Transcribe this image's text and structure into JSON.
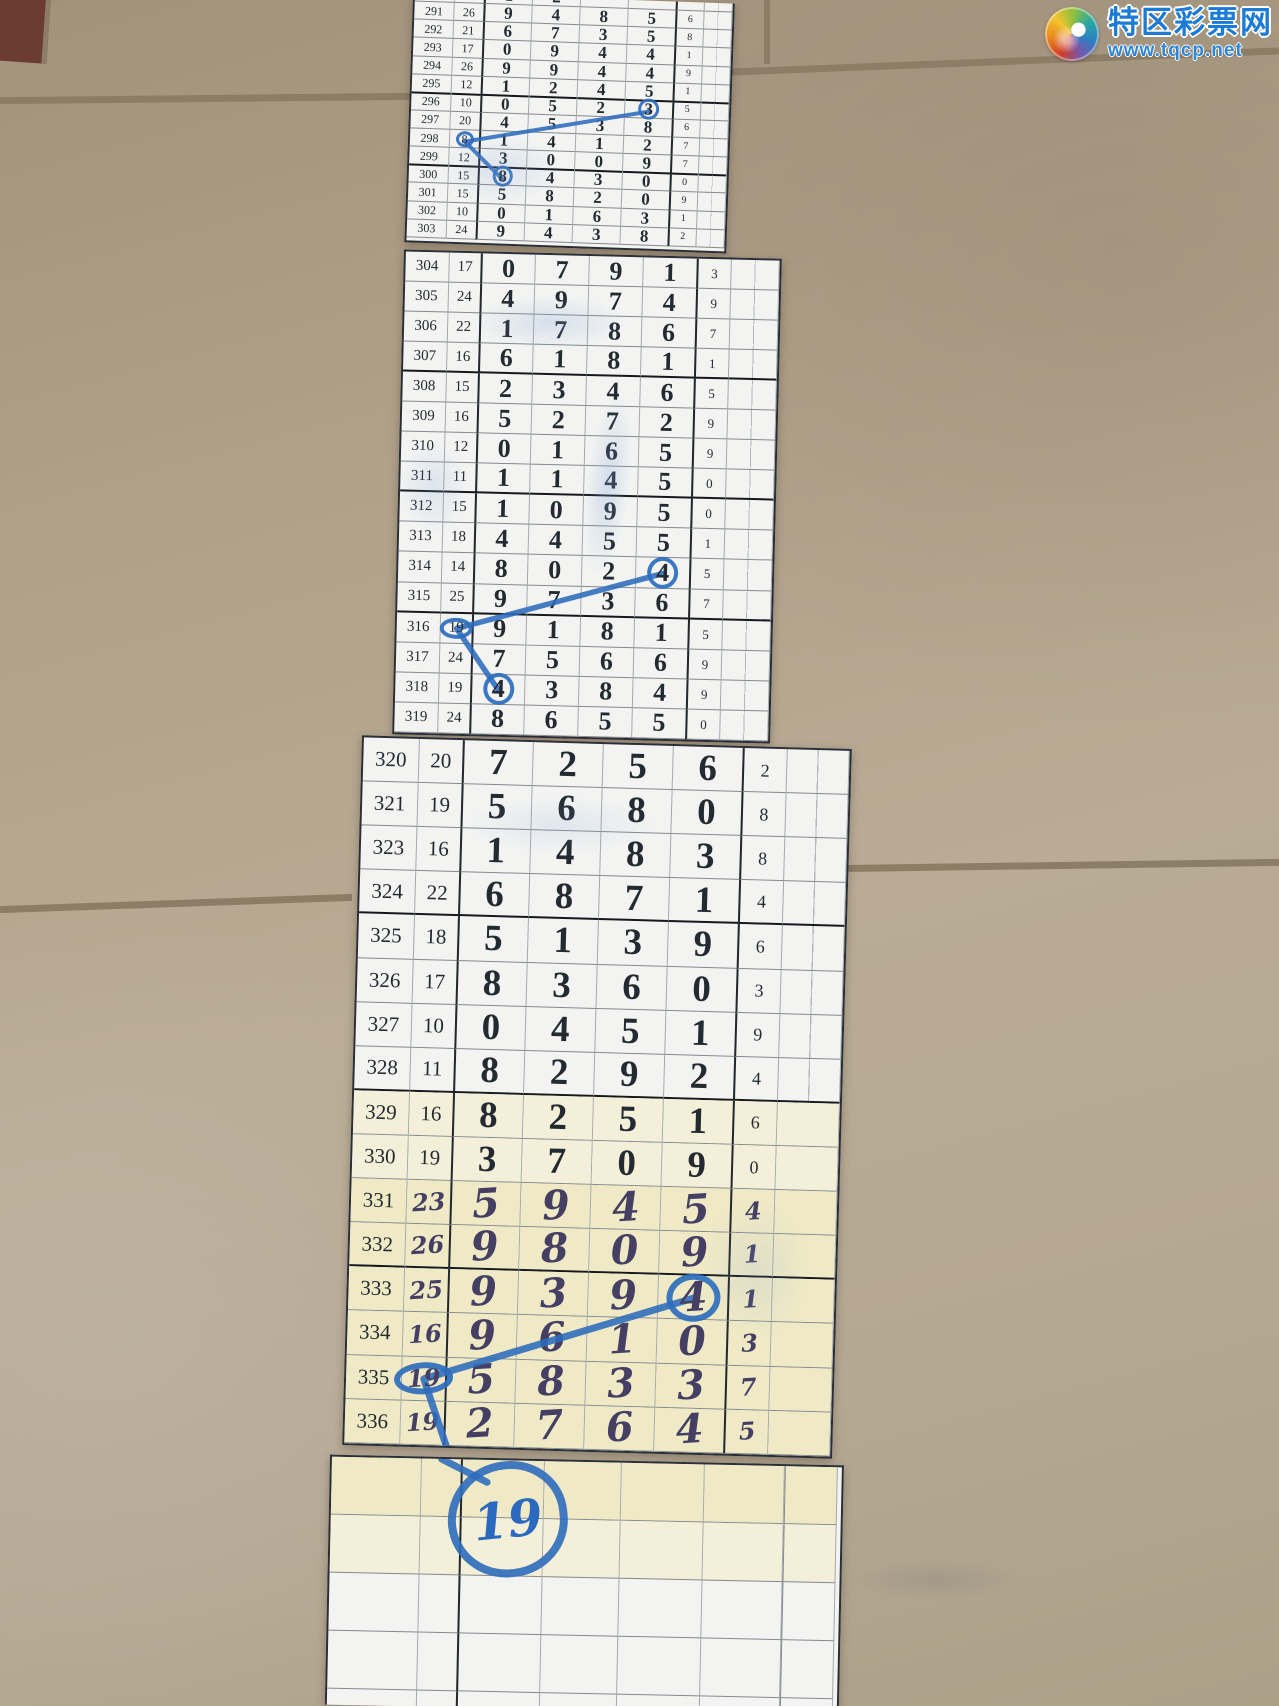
{
  "watermark": {
    "site_name": "特区彩票网",
    "site_url": "www.tqcp.net"
  },
  "colors": {
    "pen_blue": "#2d6cbd",
    "logo_blue": "#1c7bd4",
    "handwriting_ink": "#443f63",
    "paper_cream": "#efe9c5",
    "floor_tan": "#b0a089"
  },
  "sheets": [
    {
      "id": "s1",
      "rows": [
        {
          "idx": "290",
          "sum": "",
          "d": [
            "1",
            "2",
            "",
            ""
          ],
          "tail": "",
          "partial": true
        },
        {
          "idx": "291",
          "sum": "26",
          "d": [
            "9",
            "4",
            "8",
            "5"
          ],
          "tail": "6"
        },
        {
          "idx": "292",
          "sum": "21",
          "d": [
            "6",
            "7",
            "3",
            "5"
          ],
          "tail": "8"
        },
        {
          "idx": "293",
          "sum": "17",
          "d": [
            "0",
            "9",
            "4",
            "4"
          ],
          "tail": "1"
        },
        {
          "idx": "294",
          "sum": "26",
          "d": [
            "9",
            "9",
            "4",
            "4"
          ],
          "tail": "9"
        },
        {
          "idx": "295",
          "sum": "12",
          "d": [
            "1",
            "2",
            "4",
            "5"
          ],
          "tail": "1",
          "thick": true
        },
        {
          "idx": "296",
          "sum": "10",
          "d": [
            "0",
            "5",
            "2",
            "3"
          ],
          "tail": "5",
          "circled": "d3"
        },
        {
          "idx": "297",
          "sum": "20",
          "d": [
            "4",
            "5",
            "3",
            "8"
          ],
          "tail": "6"
        },
        {
          "idx": "298",
          "sum": "8",
          "d": [
            "1",
            "4",
            "1",
            "2"
          ],
          "tail": "7",
          "circled": "sum"
        },
        {
          "idx": "299",
          "sum": "12",
          "d": [
            "3",
            "0",
            "0",
            "9"
          ],
          "tail": "7",
          "thick": true
        },
        {
          "idx": "300",
          "sum": "15",
          "d": [
            "8",
            "4",
            "3",
            "0"
          ],
          "tail": "0",
          "circled": "d0"
        },
        {
          "idx": "301",
          "sum": "15",
          "d": [
            "5",
            "8",
            "2",
            "0"
          ],
          "tail": "9"
        },
        {
          "idx": "302",
          "sum": "10",
          "d": [
            "0",
            "1",
            "6",
            "3"
          ],
          "tail": "1"
        },
        {
          "idx": "303",
          "sum": "24",
          "d": [
            "9",
            "4",
            "3",
            "8"
          ],
          "tail": "2"
        }
      ]
    },
    {
      "id": "s2",
      "rows": [
        {
          "idx": "304",
          "sum": "17",
          "d": [
            "0",
            "7",
            "9",
            "1"
          ],
          "tail": "3"
        },
        {
          "idx": "305",
          "sum": "24",
          "d": [
            "4",
            "9",
            "7",
            "4"
          ],
          "tail": "9"
        },
        {
          "idx": "306",
          "sum": "22",
          "d": [
            "1",
            "7",
            "8",
            "6"
          ],
          "tail": "7"
        },
        {
          "idx": "307",
          "sum": "16",
          "d": [
            "6",
            "1",
            "8",
            "1"
          ],
          "tail": "1",
          "thick": true
        },
        {
          "idx": "308",
          "sum": "15",
          "d": [
            "2",
            "3",
            "4",
            "6"
          ],
          "tail": "5"
        },
        {
          "idx": "309",
          "sum": "16",
          "d": [
            "5",
            "2",
            "7",
            "2"
          ],
          "tail": "9"
        },
        {
          "idx": "310",
          "sum": "12",
          "d": [
            "0",
            "1",
            "6",
            "5"
          ],
          "tail": "9"
        },
        {
          "idx": "311",
          "sum": "11",
          "d": [
            "1",
            "1",
            "4",
            "5"
          ],
          "tail": "0",
          "thick": true
        },
        {
          "idx": "312",
          "sum": "15",
          "d": [
            "1",
            "0",
            "9",
            "5"
          ],
          "tail": "0"
        },
        {
          "idx": "313",
          "sum": "18",
          "d": [
            "4",
            "4",
            "5",
            "5"
          ],
          "tail": "1"
        },
        {
          "idx": "314",
          "sum": "14",
          "d": [
            "8",
            "0",
            "2",
            "4"
          ],
          "tail": "5",
          "circled": "d3"
        },
        {
          "idx": "315",
          "sum": "25",
          "d": [
            "9",
            "7",
            "3",
            "6"
          ],
          "tail": "7",
          "thick": true
        },
        {
          "idx": "316",
          "sum": "19",
          "d": [
            "9",
            "1",
            "8",
            "1"
          ],
          "tail": "5",
          "circled": "sum"
        },
        {
          "idx": "317",
          "sum": "24",
          "d": [
            "7",
            "5",
            "6",
            "6"
          ],
          "tail": "9"
        },
        {
          "idx": "318",
          "sum": "19",
          "d": [
            "4",
            "3",
            "8",
            "4"
          ],
          "tail": "9",
          "circled": "d0"
        },
        {
          "idx": "319",
          "sum": "24",
          "d": [
            "8",
            "6",
            "5",
            "5"
          ],
          "tail": "0"
        }
      ]
    },
    {
      "id": "s3",
      "rows": [
        {
          "idx": "320",
          "sum": "20",
          "d": [
            "7",
            "2",
            "5",
            "6"
          ],
          "tail": "2"
        },
        {
          "idx": "321",
          "sum": "19",
          "d": [
            "5",
            "6",
            "8",
            "0"
          ],
          "tail": "8"
        },
        {
          "idx": "323",
          "sum": "16",
          "d": [
            "1",
            "4",
            "8",
            "3"
          ],
          "tail": "8"
        },
        {
          "idx": "324",
          "sum": "22",
          "d": [
            "6",
            "8",
            "7",
            "1"
          ],
          "tail": "4",
          "thick": true
        },
        {
          "idx": "325",
          "sum": "18",
          "d": [
            "5",
            "1",
            "3",
            "9"
          ],
          "tail": "6"
        },
        {
          "idx": "326",
          "sum": "17",
          "d": [
            "8",
            "3",
            "6",
            "0"
          ],
          "tail": "3"
        },
        {
          "idx": "327",
          "sum": "10",
          "d": [
            "0",
            "4",
            "5",
            "1"
          ],
          "tail": "9"
        },
        {
          "idx": "328",
          "sum": "11",
          "d": [
            "8",
            "2",
            "9",
            "2"
          ],
          "tail": "4",
          "thick": true
        },
        {
          "idx": "329",
          "sum": "16",
          "d": [
            "8",
            "2",
            "5",
            "1"
          ],
          "tail": "6",
          "tone": "cream-light"
        },
        {
          "idx": "330",
          "sum": "19",
          "d": [
            "3",
            "7",
            "0",
            "9"
          ],
          "tail": "0",
          "tone": "cream-light"
        },
        {
          "idx": "331",
          "sum": "23",
          "d": [
            "5",
            "9",
            "4",
            "5"
          ],
          "tail": "4",
          "hand": true,
          "tone": "cream"
        },
        {
          "idx": "332",
          "sum": "26",
          "d": [
            "9",
            "8",
            "0",
            "9"
          ],
          "tail": "1",
          "hand": true,
          "tone": "cream",
          "thick": true
        },
        {
          "idx": "333",
          "sum": "25",
          "d": [
            "9",
            "3",
            "9",
            "4"
          ],
          "tail": "1",
          "hand": true,
          "tone": "cream",
          "circled": "d3"
        },
        {
          "idx": "334",
          "sum": "16",
          "d": [
            "9",
            "6",
            "1",
            "0"
          ],
          "tail": "3",
          "hand": true,
          "tone": "cream"
        },
        {
          "idx": "335",
          "sum": "19",
          "d": [
            "5",
            "8",
            "3",
            "3"
          ],
          "tail": "7",
          "hand": true,
          "tone": "cream",
          "circled": "sum"
        },
        {
          "idx": "336",
          "sum": "19",
          "d": [
            "2",
            "7",
            "6",
            "4"
          ],
          "tail": "5",
          "hand": true,
          "tone": "cream"
        }
      ]
    },
    {
      "id": "s4",
      "rows": [
        {
          "idx": "",
          "sum": "",
          "d": [
            "",
            "",
            "",
            ""
          ],
          "tail": "",
          "tone": "cream"
        },
        {
          "idx": "",
          "sum": "",
          "d": [
            "",
            "",
            "",
            ""
          ],
          "tail": "",
          "tone": "cream-light"
        },
        {
          "idx": "",
          "sum": "",
          "d": [
            "",
            "",
            "",
            ""
          ],
          "tail": ""
        },
        {
          "idx": "",
          "sum": "",
          "d": [
            "",
            "",
            "",
            ""
          ],
          "tail": ""
        },
        {
          "idx": "",
          "sum": "",
          "d": [
            "",
            "",
            "",
            ""
          ],
          "tail": ""
        }
      ]
    }
  ],
  "annotations": {
    "pen_lines": [
      {
        "sheet": "s1",
        "points": [
          [
            74.8,
            44.7
          ],
          [
            17.3,
            59.4
          ],
          [
            29.6,
            74.2
          ]
        ]
      },
      {
        "sheet": "s2",
        "points": [
          [
            70.9,
            65.6
          ],
          [
            16.0,
            78.1
          ],
          [
            27.5,
            90.6
          ]
        ]
      },
      {
        "sheet": "s3",
        "points": [
          [
            71.0,
            78.1
          ],
          [
            16.0,
            90.6
          ],
          [
            21.0,
            100
          ]
        ]
      },
      {
        "sheet": "s4",
        "points": [
          [
            21.5,
            0
          ],
          [
            30.5,
            9
          ]
        ]
      }
    ],
    "big_circle": {
      "label": "19"
    }
  }
}
